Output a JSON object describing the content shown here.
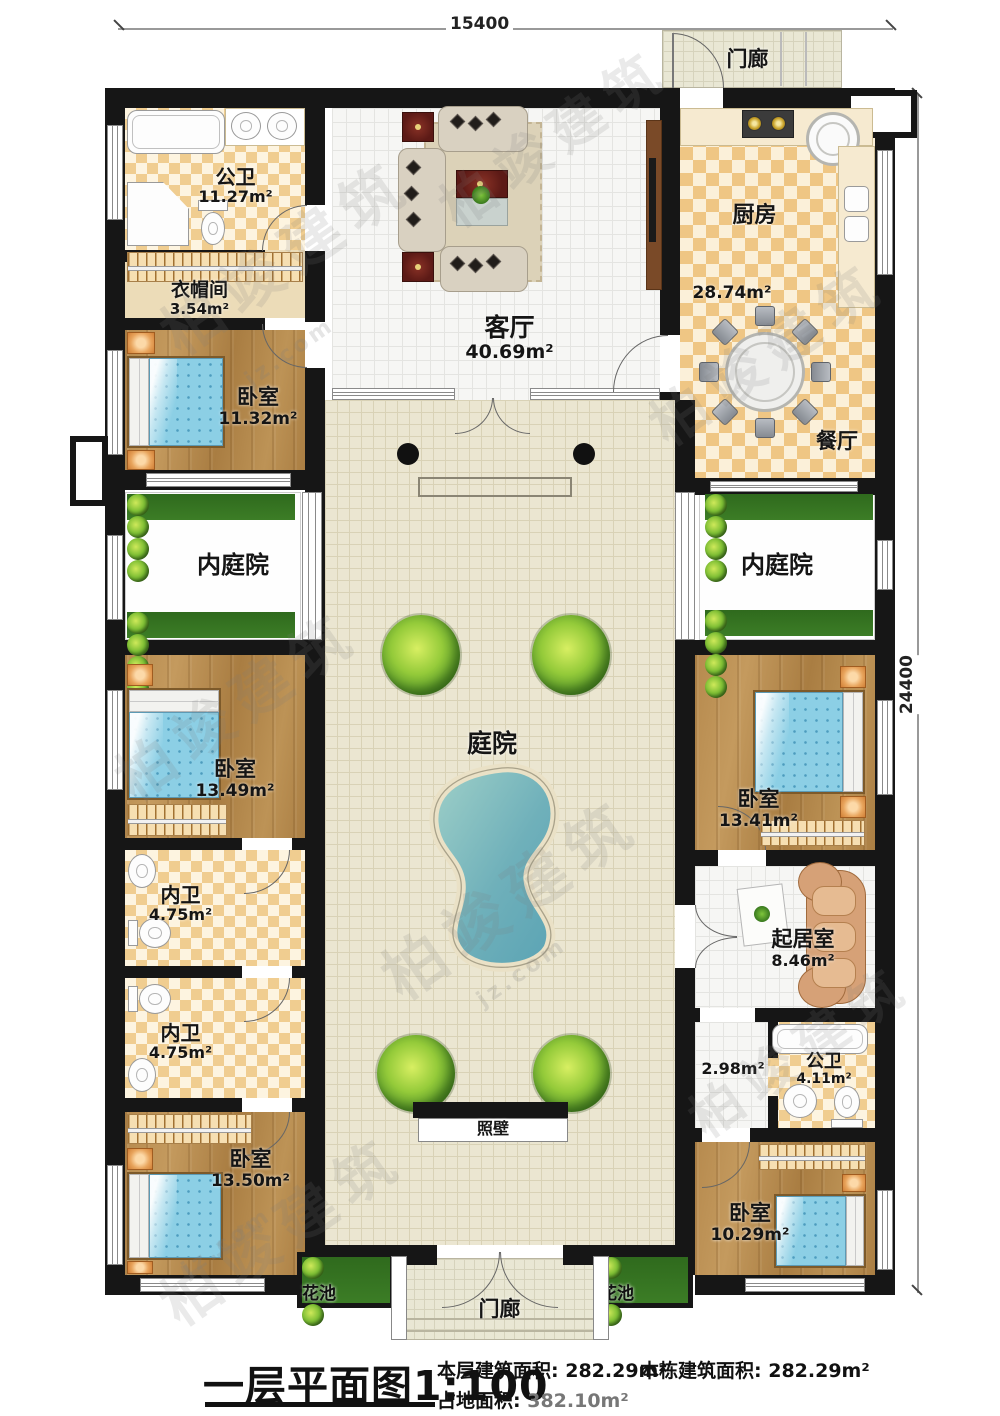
{
  "dimensions": {
    "top": "15400",
    "right": "24400"
  },
  "rooms": {
    "bath_top": {
      "name": "公卫",
      "area": "11.27m²"
    },
    "cloakroom": {
      "name": "衣帽间",
      "area": "3.54m²"
    },
    "bedroom1": {
      "name": "卧室",
      "area": "11.32m²"
    },
    "inner_court_left": {
      "name": "内庭院"
    },
    "bedroom2": {
      "name": "卧室",
      "area": "13.49m²"
    },
    "inner_bath1": {
      "name": "内卫",
      "area": "4.75m²"
    },
    "inner_bath2": {
      "name": "内卫",
      "area": "4.75m²"
    },
    "bedroom3": {
      "name": "卧室",
      "area": "13.50m²"
    },
    "living_room": {
      "name": "客厅",
      "area": "40.69m²"
    },
    "kitchen": {
      "name": "厨房",
      "area": "28.74m²"
    },
    "dining_room": {
      "name": "餐厅"
    },
    "inner_court_right": {
      "name": "内庭院"
    },
    "bedroom4": {
      "name": "卧室",
      "area": "13.41m²"
    },
    "sitting_room": {
      "name": "起居室",
      "area": "8.46m²"
    },
    "hallway": {
      "area": "2.98m²"
    },
    "bath_right": {
      "name": "公卫",
      "area": "4.11m²"
    },
    "bedroom5": {
      "name": "卧室",
      "area": "10.29m²"
    },
    "courtyard": {
      "name": "庭院"
    },
    "screen_wall": {
      "name": "照壁"
    },
    "porch_top": {
      "name": "门廊"
    },
    "porch_bottom": {
      "name": "门廊"
    },
    "flower_bed_left": {
      "name": "花池"
    },
    "flower_bed_right": {
      "name": "花池"
    }
  },
  "footer": {
    "title": "一层平面图",
    "scale": "1:100",
    "stats": [
      {
        "label": "本层建筑面积:",
        "value": "282.29m²"
      },
      {
        "label": "本栋建筑面积:",
        "value": "282.29m²"
      },
      {
        "label": "占地面积:",
        "value": "382.10m²"
      }
    ]
  },
  "watermark": {
    "brand": "柏竣建筑",
    "url": "jz.com"
  }
}
